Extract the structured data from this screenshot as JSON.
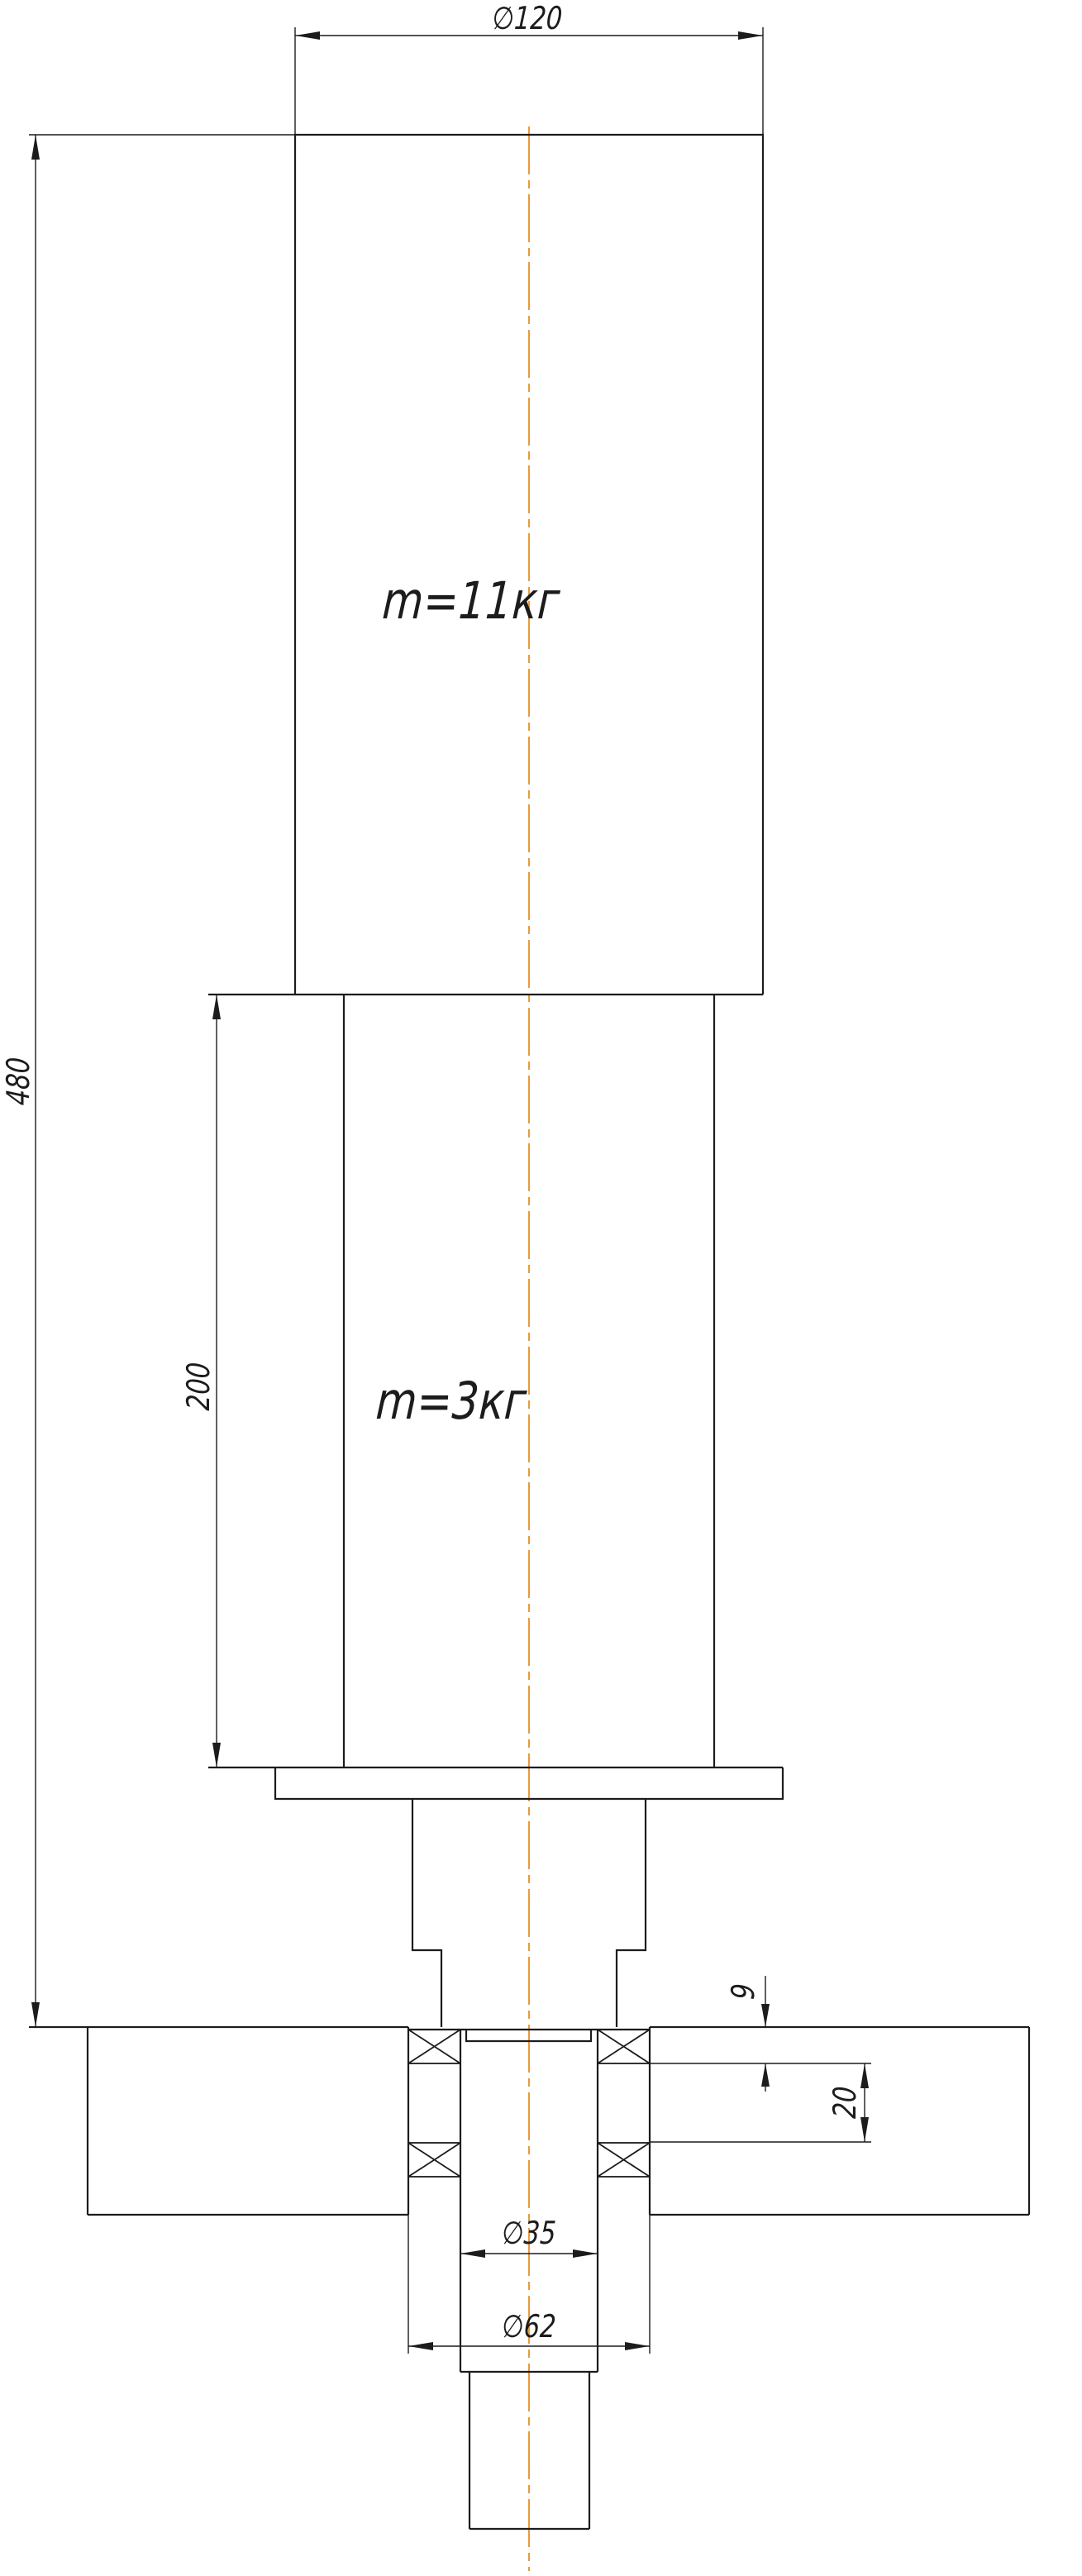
{
  "drawing": {
    "type": "engineering-drawing",
    "colors": {
      "line": "#1c1c1c",
      "centerline": "#e89b3c",
      "background": "#ffffff"
    },
    "labels": {
      "dia_top": "∅120",
      "height_total": "480",
      "height_mid": "200",
      "mass_top": "m=11кг",
      "mass_mid": "m=3кг",
      "dia_shaft": "∅35",
      "dia_bore": "∅62",
      "bearing_width": "9",
      "bearing_gap": "20"
    }
  }
}
